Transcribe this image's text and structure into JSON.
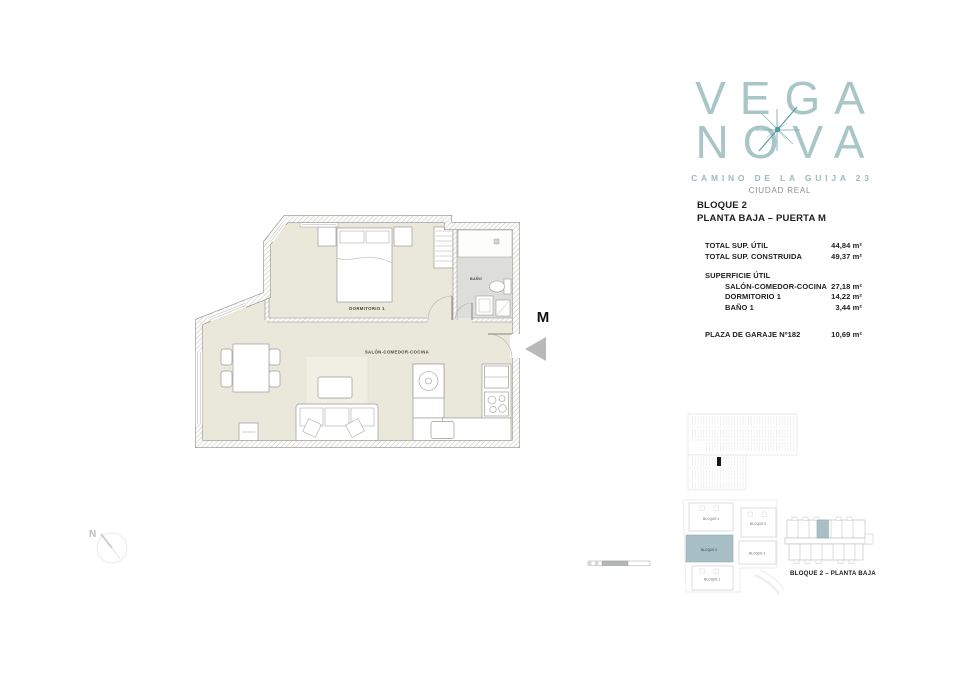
{
  "brand": {
    "name_line1": "VEGA",
    "name_line2": "NOVA",
    "address": "CAMINO DE LA GUIJA 23",
    "city": "CIUDAD REAL",
    "logo_color": "#A9C6C7",
    "star_color": "#4F98A1"
  },
  "unit_header": {
    "block": "BLOQUE 2",
    "floor_door": "PLANTA BAJA – PUERTA M"
  },
  "surface_table": {
    "rows": [
      {
        "label": "TOTAL SUP. ÚTIL",
        "value": "44,84 m²"
      },
      {
        "label": "TOTAL SUP. CONSTRUIDA",
        "value": "49,37 m²"
      },
      {
        "label": "SUPERFICIE ÚTIL",
        "value": ""
      },
      {
        "label": "SALÓN-COMEDOR-COCINA",
        "value": "27,18 m²"
      },
      {
        "label": "DORMITORIO 1",
        "value": "14,22 m²"
      },
      {
        "label": "BAÑO 1",
        "value": "3,44 m²"
      },
      {
        "label": "PLAZA DE GARAJE Nº182",
        "value": "10,69 m²"
      }
    ]
  },
  "floorplan": {
    "room_labels": {
      "bedroom": "DORMITORIO 1",
      "living": "SALÓN-COMEDOR-COCINA",
      "bathroom": "BAÑO"
    },
    "door_letter": "M",
    "floor_color": "#EAE7DB",
    "bathroom_floor_color": "#DDDDDB"
  },
  "compass": {
    "north_label": "N"
  },
  "key_plans": {
    "site_blocks": [
      {
        "label": "BLOQUE 4"
      },
      {
        "label": "BLOQUE 5"
      },
      {
        "label": "BLOQUE 2",
        "highlighted": true
      },
      {
        "label": "BLOQUE 3"
      },
      {
        "label": "BLOQUE 1"
      }
    ],
    "caption": "BLOQUE 2 – PLANTA BAJA",
    "highlight_color": "#A8BFC6"
  }
}
